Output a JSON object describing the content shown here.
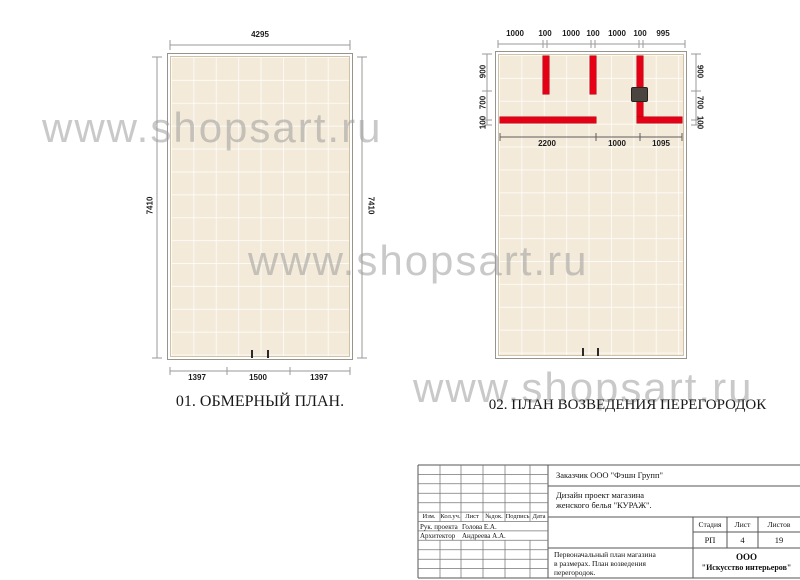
{
  "watermark": {
    "text": "www.shopsart.ru"
  },
  "colors": {
    "partition_red": "#e60016",
    "floor_beige": "#f3ead9",
    "watermark_gray": "#9e9e9e"
  },
  "plan1": {
    "title": "01. ОБМЕРНЫЙ ПЛАН.",
    "dim_top": "4295",
    "dim_left": "7410",
    "dim_right": "7410",
    "dims_bottom": [
      "1397",
      "1500",
      "1397"
    ]
  },
  "plan2": {
    "title": "02. ПЛАН ВОЗВЕДЕНИЯ ПЕРЕГОРОДОК",
    "dims_top": [
      "1000",
      "100",
      "1000",
      "100",
      "1000",
      "100",
      "995"
    ],
    "dims_left": [
      "900",
      "700",
      "100"
    ],
    "dims_right": [
      "900",
      "700",
      "100"
    ],
    "dims_inner": [
      "2200",
      "1000",
      "1095"
    ]
  },
  "title_block": {
    "customer": "Заказчик ООО \"Фэшн Групп\"",
    "project_line1": "Дизайн проект магазина",
    "project_line2": "женского белья \"КУРАЖ\".",
    "columns": [
      "Изм.",
      "Кол.уч.",
      "Лист",
      "№док.",
      "Подпись",
      "Дата"
    ],
    "roles": [
      {
        "role": "Рук. проекта",
        "name": "Голова Е.А."
      },
      {
        "role": "Архитектор",
        "name": "Андреева А.А."
      }
    ],
    "stage_label": "Стадия",
    "sheet_label": "Лист",
    "sheets_label": "Листов",
    "stage_value": "РП",
    "sheet_value": "4",
    "sheets_value": "19",
    "desc_line1": "Первоначальный план магазина",
    "desc_line2": "в размерах. План возведения",
    "desc_line3": "перегородок.",
    "company_line1": "ООО",
    "company_line2": "\"Искусство интерьеров\""
  }
}
